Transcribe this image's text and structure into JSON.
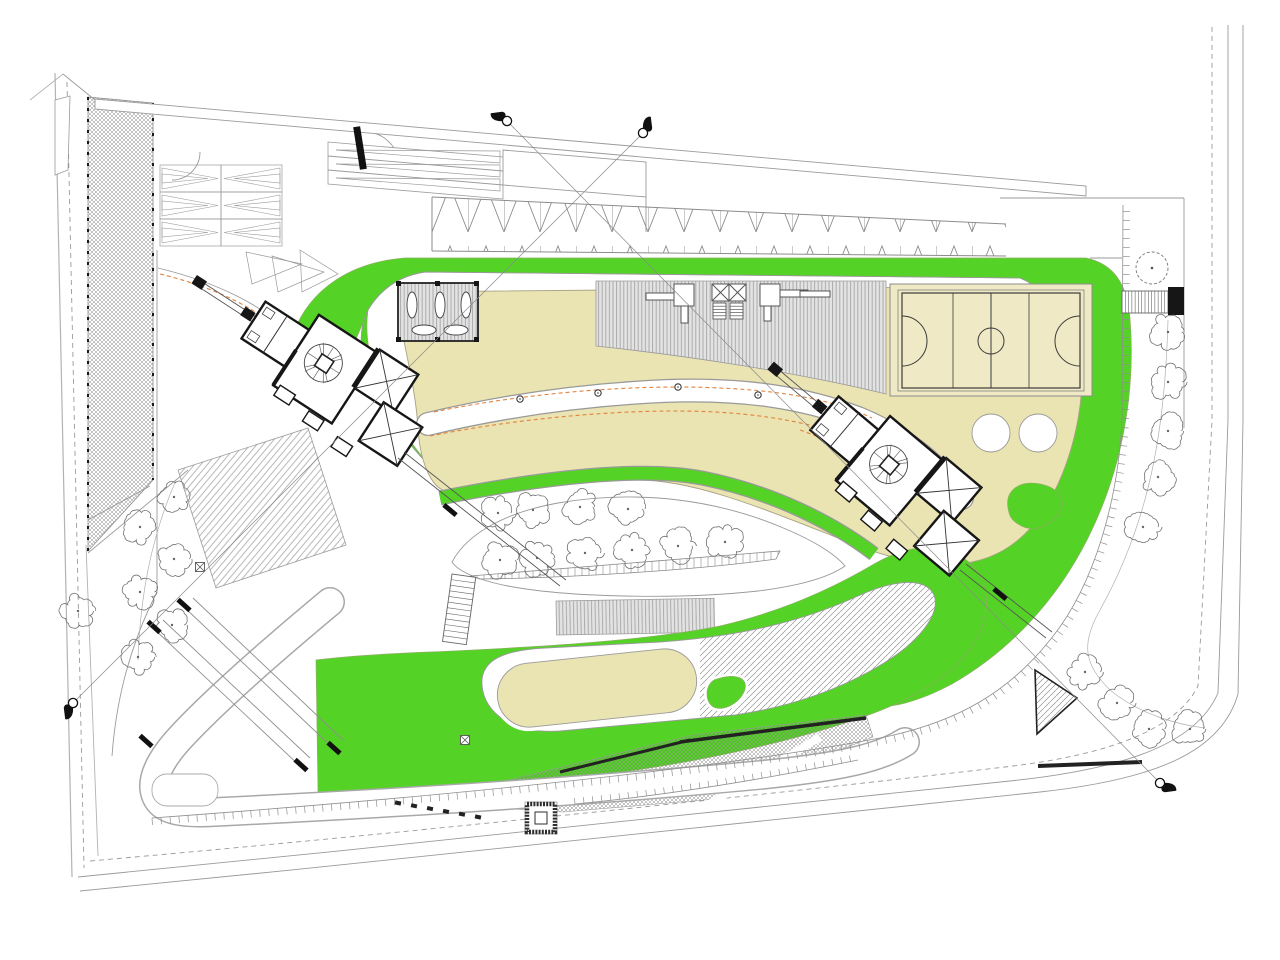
{
  "document": {
    "kind": "architectural-site-plan",
    "description": "Master plan drawing: park with playgrounds, basketball court, two residential tower footprints, tree rows, ramps and section markers",
    "visible_text": []
  },
  "palette": {
    "green": "#55d226",
    "beige": "#eae3b2",
    "court": "#efe9c5",
    "deck": "#e3e3e3",
    "deck_stripe": "#a6a6a6",
    "line": "#9a9a9a",
    "line_dark": "#3a3a3a",
    "wall": "#161616",
    "orange": "#e2833c",
    "tree": "#707070",
    "boundary": "#b3b3b3",
    "white": "#ffffff"
  },
  "trees": {
    "street_left": {
      "r": 16,
      "pts": [
        [
          174,
          497
        ],
        [
          140,
          527
        ],
        [
          174,
          559
        ],
        [
          140,
          592
        ],
        [
          172,
          625
        ],
        [
          138,
          657
        ],
        [
          78,
          611
        ]
      ]
    },
    "street_right": {
      "r": 17,
      "pts": [
        [
          1168,
          332
        ],
        [
          1168,
          382
        ],
        [
          1168,
          431
        ],
        [
          1158,
          477
        ],
        [
          1143,
          527
        ],
        [
          1085,
          672
        ],
        [
          1117,
          703
        ],
        [
          1149,
          729
        ],
        [
          1190,
          729
        ]
      ]
    },
    "plaza": {
      "r": 17,
      "pts": [
        [
          498,
          513
        ],
        [
          533,
          510
        ],
        [
          580,
          507
        ],
        [
          628,
          509
        ],
        [
          500,
          560
        ],
        [
          537,
          558
        ],
        [
          585,
          553
        ],
        [
          632,
          550
        ],
        [
          678,
          546
        ],
        [
          725,
          542
        ]
      ]
    },
    "proposed": {
      "r": 16,
      "pts": [
        [
          1152,
          268
        ]
      ]
    }
  },
  "lamps": [
    [
      520,
      399
    ],
    [
      598,
      393
    ],
    [
      678,
      387
    ],
    [
      758,
      395
    ],
    [
      838,
      422
    ]
  ],
  "section_markers": [
    {
      "x": 507,
      "y": 121,
      "angle": 225
    },
    {
      "x": 643,
      "y": 133,
      "angle": -45
    },
    {
      "x": 73,
      "y": 703,
      "angle": 135
    },
    {
      "x": 1160,
      "y": 783,
      "angle": 45
    }
  ],
  "leader_lines": [
    [
      507,
      121,
      1160,
      783
    ],
    [
      643,
      133,
      73,
      703
    ]
  ],
  "xmarks": [
    [
      200,
      567
    ],
    [
      465,
      740
    ]
  ],
  "wall_caps": [
    [
      146,
      741,
      42,
      16,
      5
    ],
    [
      184,
      605,
      42,
      16,
      5
    ],
    [
      334,
      748,
      42,
      16,
      5
    ],
    [
      154,
      627,
      42,
      16,
      5
    ],
    [
      301,
      765,
      42,
      16,
      5
    ],
    [
      450,
      510,
      40,
      16,
      5
    ],
    [
      1000,
      594,
      40,
      16,
      5
    ],
    [
      360,
      148,
      81,
      43,
      7
    ]
  ],
  "teeth_row": {
    "x1": 398,
    "y1": 803,
    "x2": 478,
    "y2": 817,
    "n": 6
  },
  "summary": {
    "towers": 2,
    "basketball_courts": 1,
    "pergolas": 1,
    "play_decks": 2,
    "tree_count": 27
  }
}
